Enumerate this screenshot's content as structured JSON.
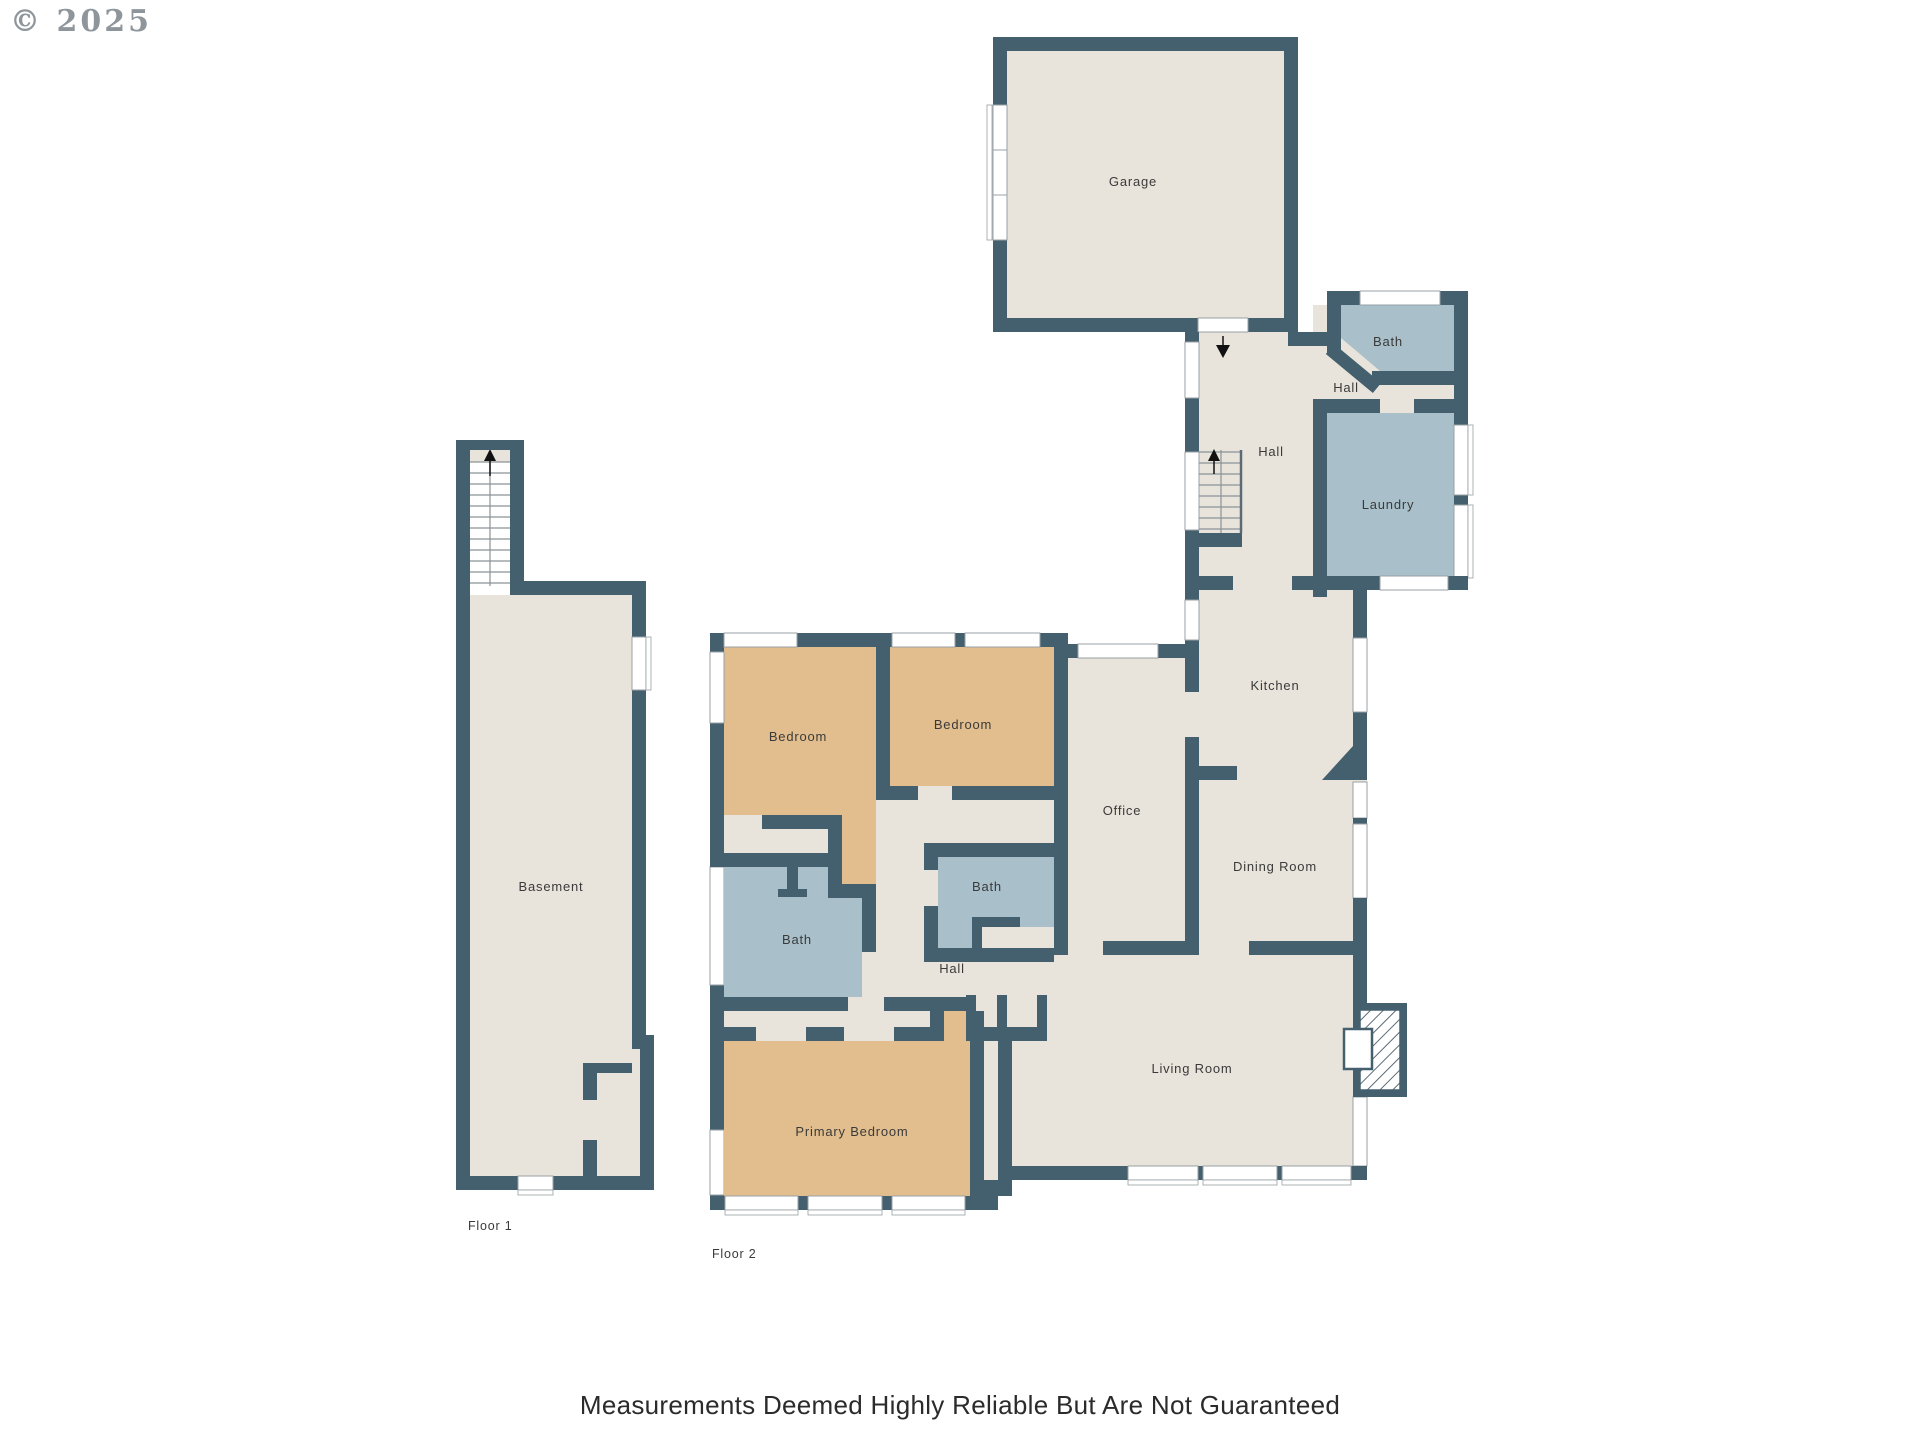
{
  "meta": {
    "copyright": "© 2025",
    "disclaimer": "Measurements Deemed Highly Reliable But Are Not Guaranteed"
  },
  "colors": {
    "wall": "#44606e",
    "floor": "#e9e4db",
    "bedroom": "#e2be8e",
    "bath": "#a9c0cb"
  },
  "floor1": {
    "label": "Floor 1",
    "rooms": {
      "basement": "Basement"
    }
  },
  "floor2": {
    "label": "Floor 2",
    "rooms": {
      "garage": "Garage",
      "bath_upper": "Bath",
      "hall_small": "Hall",
      "hall_entry": "Hall",
      "laundry": "Laundry",
      "kitchen": "Kitchen",
      "dining": "Dining Room",
      "office": "Office",
      "bedroom_left": "Bedroom",
      "bedroom_right": "Bedroom",
      "bath_main": "Bath",
      "bath_small": "Bath",
      "hall_middle": "Hall",
      "living": "Living Room",
      "primary": "Primary Bedroom"
    }
  }
}
